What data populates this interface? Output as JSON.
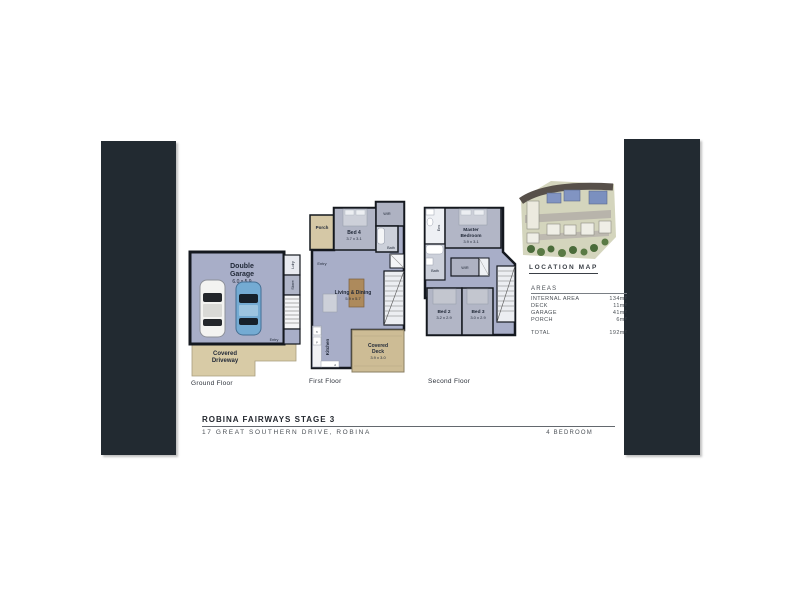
{
  "decor": {
    "panel_color": "#222a31"
  },
  "plans": {
    "ground": {
      "label": "Ground Floor",
      "garage_name1": "Double",
      "garage_name2": "Garage",
      "garage_dims": "6.0 x 5.9",
      "driveway1": "Covered",
      "driveway2": "Driveway",
      "ldry": "Ldry",
      "store": "Store",
      "entry": "Entry"
    },
    "first": {
      "label": "First Floor",
      "porch": "Porch",
      "entry": "Entry",
      "bed4_name": "Bed 4",
      "bed4_dims": "3.7 x 3.1",
      "wir": "WIR",
      "bath": "Bath",
      "living_name": "Living & Dining",
      "living_dims": "5.9 x 5.7",
      "kitchen": "Kitchen",
      "deck1": "Covered",
      "deck2": "Deck",
      "deck_dims": "3.9 x 3.0",
      "app_fr": "fr",
      "app_p": "p",
      "app_d": "d"
    },
    "second": {
      "label": "Second Floor",
      "ens": "Ens",
      "bath": "Bath",
      "wir": "WIR",
      "master_name1": "Master",
      "master_name2": "Bedroom",
      "master_dims": "3.9 x 3.1",
      "bed2_name": "Bed 2",
      "bed2_dims": "3.2 x 2.9",
      "bed3_name": "Bed 3",
      "bed3_dims": "3.0 x 2.9"
    }
  },
  "location_map": {
    "label": "LOCATION MAP"
  },
  "areas": {
    "header": "AREAS",
    "rows": [
      {
        "label": "INTERNAL AREA",
        "value": "134m²"
      },
      {
        "label": "DECK",
        "value": "11m²"
      },
      {
        "label": "GARAGE",
        "value": "41m²"
      },
      {
        "label": "PORCH",
        "value": "6m²"
      }
    ],
    "total_label": "TOTAL",
    "total_value": "192m²"
  },
  "title_block": {
    "title": "ROBINA FAIRWAYS STAGE 3",
    "address": "17 GREAT SOUTHERN DRIVE, ROBINA",
    "bedrooms": "4 BEDROOM"
  }
}
